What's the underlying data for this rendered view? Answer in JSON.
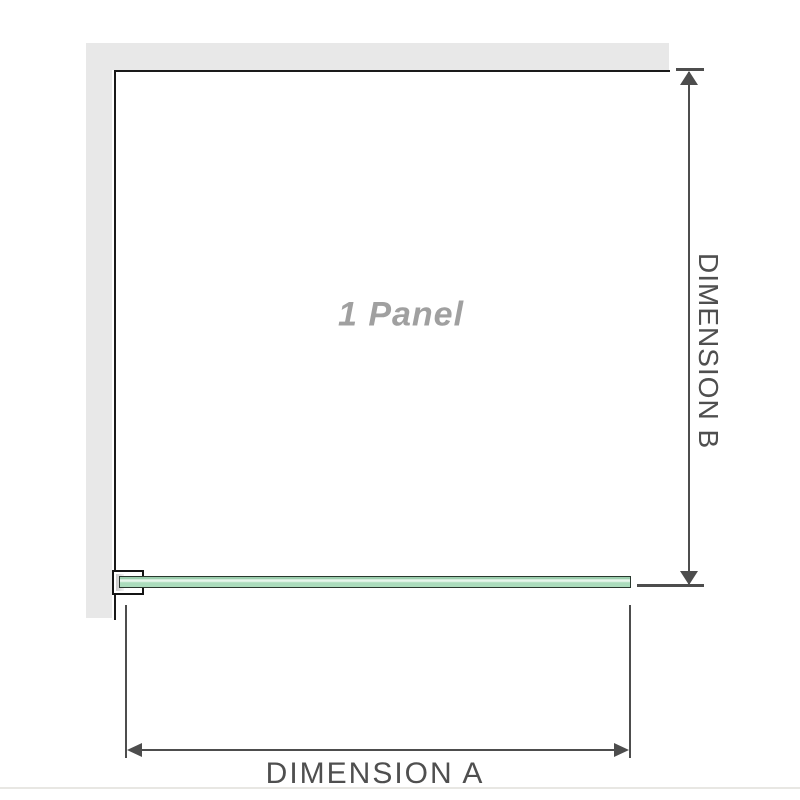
{
  "diagram": {
    "panel_label": "1 Panel",
    "dimensions": {
      "horizontal_label": "DIMENSION A",
      "vertical_label": "DIMENSION B"
    },
    "colors": {
      "wall_fill": "#e8e8e8",
      "panel_border": "#1a1a1a",
      "dimension_line": "#4d4d4d",
      "dimension_text": "#4f4f4f",
      "panel_label_text": "#a0a0a0",
      "glass_fill": "#abdcbc",
      "glass_highlight": "#e7f6ec",
      "glass_outline": "#29382e",
      "bracket_outline": "#141414",
      "bracket_gasket": "#c9c9c9",
      "baseline_rule": "#e8e7e3"
    }
  }
}
